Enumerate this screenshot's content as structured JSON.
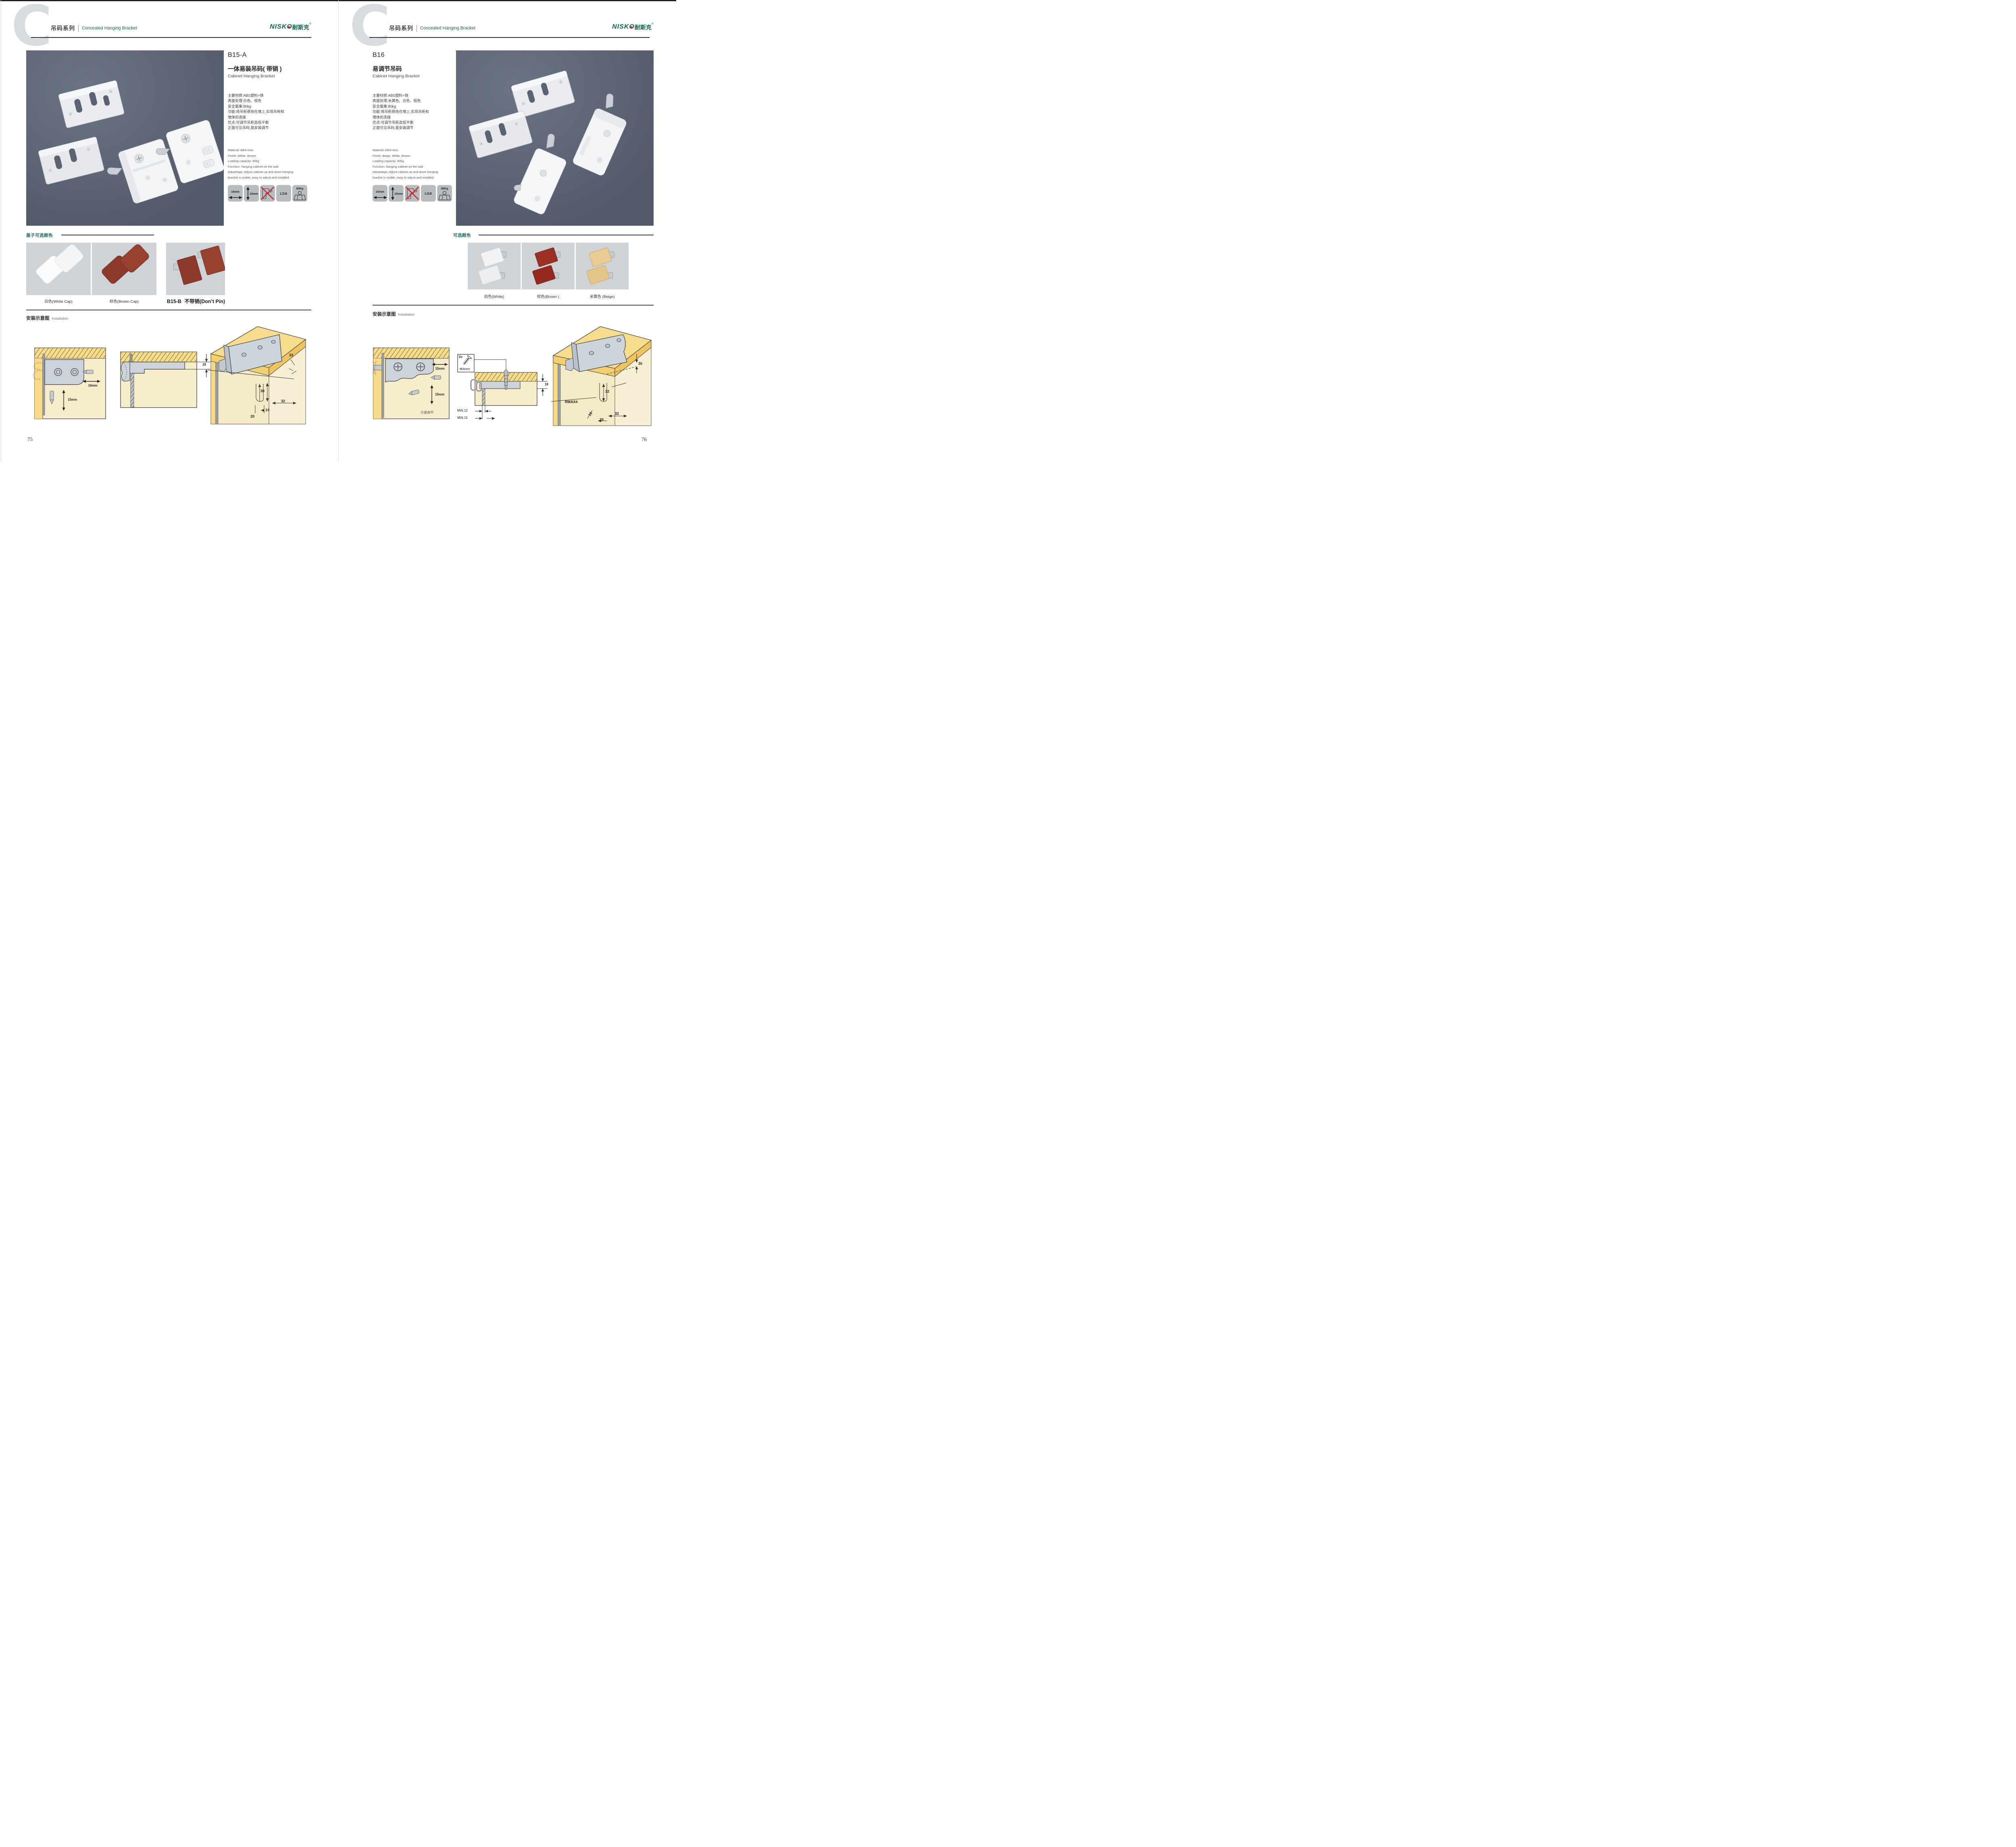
{
  "palette": {
    "accent_green": "#15714e",
    "logo_green": "#0c684b",
    "logo_red": "#d6242a",
    "photo_bg": "#5a6273",
    "icon_box_gray": "#b7bcc0",
    "swatch_gray": "#ced3d7",
    "no_drill_red": "#d6242a",
    "swatch_white": "#f5f5f5",
    "swatch_brown": "#8e3a2a",
    "swatch_beige": "#e7c98f"
  },
  "header": {
    "series_letter": "C",
    "series_cn": "吊码系列",
    "series_en": "Concealed Hanging Bracket",
    "logo_text": "NISKO",
    "logo_cn": "耐斯克",
    "logo_reg": "®"
  },
  "left": {
    "page_number": "75",
    "product": {
      "code": "B15-A",
      "name_cn": "一体易装吊码( 带销 )",
      "name_en": "Cabinet Hanging Bracket",
      "specs_cn": [
        "主要材质:ABS塑料+铁",
        "表面处理:白色、棕色",
        "安全载重:80kg",
        "功能:将吊柜悬挂在墙上,实现吊柜和",
        "墙体的连接",
        "优点:可调节吊柜高低平衡",
        "正面可见吊码,易安装调节"
      ],
      "specs_en": [
        "Material: ABS+iron",
        "Finish: White, Brown",
        "Loading capacity: 80kg",
        "Function: hanging cabinet on the wall",
        "Advantage: Adjust cabinet up and down hanging",
        "bracket is visible, easy to adjust and installed"
      ],
      "icon_width": "16mm",
      "icon_height": "15mm",
      "icon_cert": "LGA",
      "icon_load": "80Kg"
    },
    "colors": {
      "title": "盖子可选颜色",
      "labels": [
        "白色(White Cap)",
        "棕色(Brown Cap)"
      ],
      "b15b_code": "B15-B",
      "b15b_label": "不带销(Don’t Pin)"
    },
    "install": {
      "title_cn": "安装示意图",
      "title_en": "Installation",
      "d1_w": "16mm",
      "d1_h": "15mm",
      "d2_dim": "18",
      "d3_dims": {
        "a": "33",
        "b": "30",
        "c": "32",
        "d": "20",
        "e": "14"
      }
    }
  },
  "right": {
    "page_number": "76",
    "product": {
      "code": "B16",
      "name_cn": "易调节吊码",
      "name_en": "Cabinet Hanging Bracket",
      "specs_cn": [
        "主要材质:ABS塑料+铁",
        "表面处理:米黄色、白色、棕色",
        "安全载重:80kg",
        "功能:将吊柜悬挂在墙上,实现吊柜和",
        "墙体的连接",
        "优点:可调节吊柜高低平衡",
        "正面可见吊码,易安装调节"
      ],
      "specs_en": [
        "Material: ABS+iron",
        "Finish: Beige, White, Brown",
        "Loading capacity: 80kg",
        "Function: hanging cabinet on the wall",
        "Advantage: Adjust cabinet up and down hanging",
        "bracket is visible, easy to adjust and installed"
      ],
      "icon_width": "10mm",
      "icon_height": "15mm",
      "icon_cert": "LGA",
      "icon_load": "80Kg"
    },
    "colors": {
      "title": "可选颜色",
      "labels": [
        "白色(White)",
        "棕色(Brown )",
        "米黄色 (Beige)"
      ]
    },
    "install": {
      "title_cn": "安装示意图",
      "title_en": "Installation",
      "d1_w": "15mm",
      "d1_h": "15mm",
      "d1_note": "方便调节",
      "d2_qty": "2x",
      "d2_dia": "Φ4mm",
      "d2_dim": "19",
      "d2_min1": "MIN.12",
      "d2_min2": "MIN.15",
      "d3_dims": {
        "a": "30",
        "b": "32",
        "c": "RMAX4",
        "d": "19",
        "e": "20",
        "f": "32"
      }
    }
  }
}
